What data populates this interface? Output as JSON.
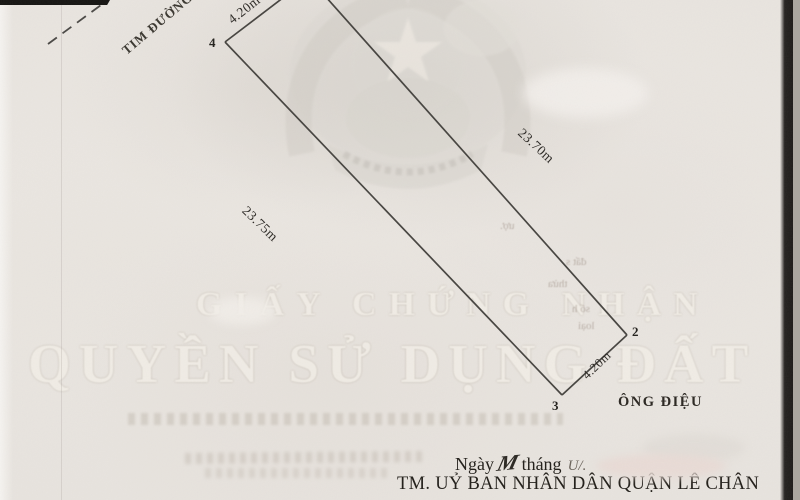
{
  "diagram": {
    "road_label": "TIM ĐƯỜNG",
    "dim_top": "4.20m",
    "dim_right": "23.70m",
    "dim_left": "23.75m",
    "dim_bottom": "4.20m",
    "corner_2": "2",
    "corner_3": "3",
    "corner_4": "4",
    "neighbor": "ÔNG ĐIỆU"
  },
  "watermark": {
    "line1": "GIẤY CHỨNG NHẬN",
    "line2": "QUYỀN SỬ DỤNG ĐẤT"
  },
  "bleed": {
    "fragments": [
      "ượ.",
      "đất s",
      "thửa",
      "số h",
      "loại"
    ]
  },
  "footer": {
    "ngay": "Ngày",
    "day_script": "M",
    "thang": "tháng",
    "month_script": "U/.",
    "authority": "TM. UỶ BAN NHÂN DÂN QUẬN LÊ CHÂN"
  },
  "colors": {
    "paper": "#eae6e1",
    "ink": "#272420",
    "boundary_line": "#45433f",
    "watermark_text": "#f2eee7",
    "redaction_pink": "#e9dbd6"
  }
}
